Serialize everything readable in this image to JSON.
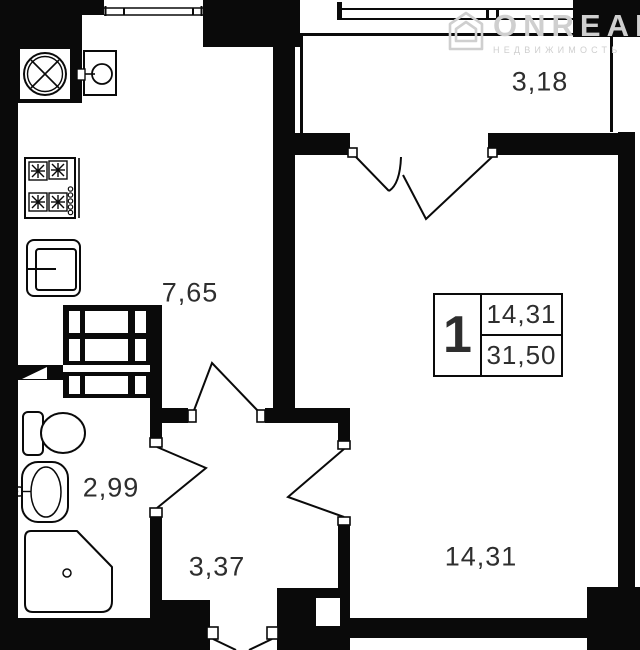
{
  "watermark": {
    "brand": "ONREALT",
    "tagline": "НЕДВИЖИМОСТЬ"
  },
  "rooms": {
    "kitchen": {
      "area": "7,65"
    },
    "balcony": {
      "area": "3,18"
    },
    "bathroom": {
      "area": "2,99"
    },
    "hallway": {
      "area": "3,37"
    },
    "living": {
      "area": "14,31"
    }
  },
  "legend": {
    "room_count": "1",
    "living_area": "14,31",
    "total_area": "31,50"
  },
  "colors": {
    "wall": "#0a0a0a",
    "label": "#2e2e2e",
    "watermark": "#cfcfcf"
  }
}
